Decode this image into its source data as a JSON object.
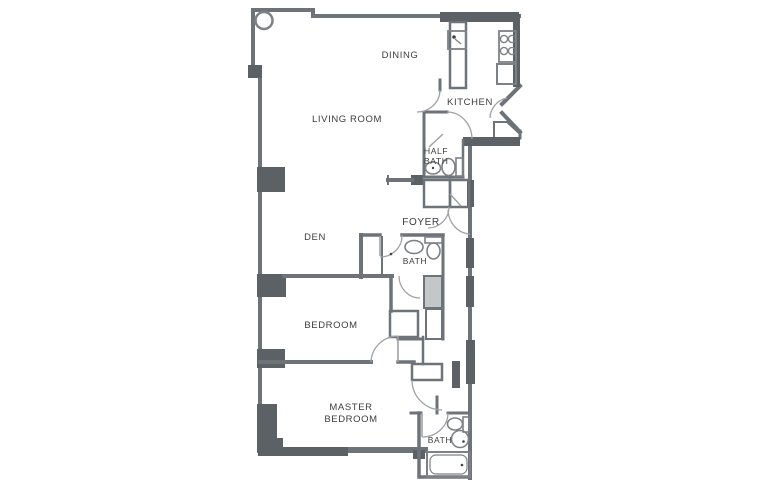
{
  "plan": {
    "type": "apartment-floor-plan",
    "background": "#ffffff",
    "colors": {
      "wall": "#6e737a",
      "wall_dark": "#5c6166",
      "fixture": "#7d8186",
      "door_arc": "#9fa2a6",
      "label_text": "#3b3d3f",
      "closet_shade": "#c4c7c9"
    },
    "rooms": {
      "dining": {
        "label": "DINING"
      },
      "kitchen": {
        "label": "KITCHEN"
      },
      "living_room": {
        "label": "LIVING ROOM"
      },
      "half_bath": {
        "label_line1": "HALF",
        "label_line2": "BATH"
      },
      "foyer": {
        "label": "FOYER"
      },
      "den": {
        "label": "DEN"
      },
      "bath": {
        "label": "BATH"
      },
      "bedroom": {
        "label": "BEDROOM"
      },
      "master_bedroom": {
        "label_line1": "MASTER",
        "label_line2": "BEDROOM"
      },
      "master_bath": {
        "label": "BATH"
      }
    },
    "fixtures": [
      "column",
      "kitchen-sink",
      "stove",
      "refrigerator",
      "half-bath-sink",
      "half-bath-toilet",
      "bath-sink",
      "bath-toilet",
      "master-bath-toilet",
      "master-bath-sink",
      "bathtub"
    ]
  }
}
